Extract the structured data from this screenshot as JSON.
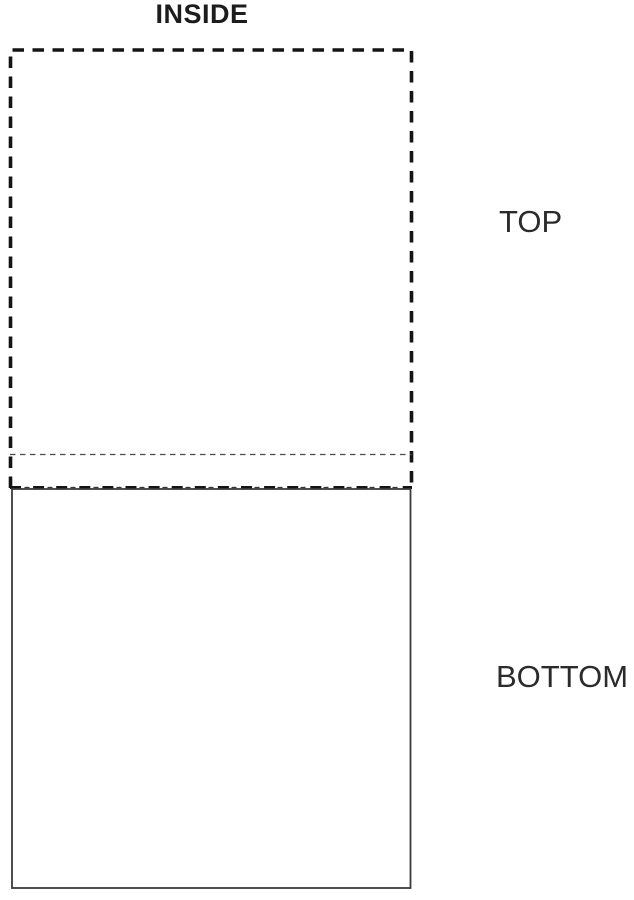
{
  "title": "INSIDE",
  "labels": {
    "top": "TOP",
    "bottom": "BOTTOM"
  },
  "panels": {
    "top_panel": {
      "label": "TOP",
      "outline_style": "heavy-dashed"
    },
    "bottom_panel": {
      "label": "BOTTOM",
      "outline_style": "solid"
    },
    "fold_lines": [
      {
        "name": "fine-dashed-fold-line",
        "style": "dashed-thin"
      },
      {
        "name": "dash-dot-crease-line",
        "style": "dash-dot-thick"
      }
    ]
  },
  "colors": {
    "heavy_dash_line": "#141414",
    "fine_dash_line": "#4a4a4a",
    "solid_outline": "#3a3a3a",
    "title_text": "#1c1c1c",
    "label_text": "#2b2b2b",
    "background": "#ffffff"
  }
}
